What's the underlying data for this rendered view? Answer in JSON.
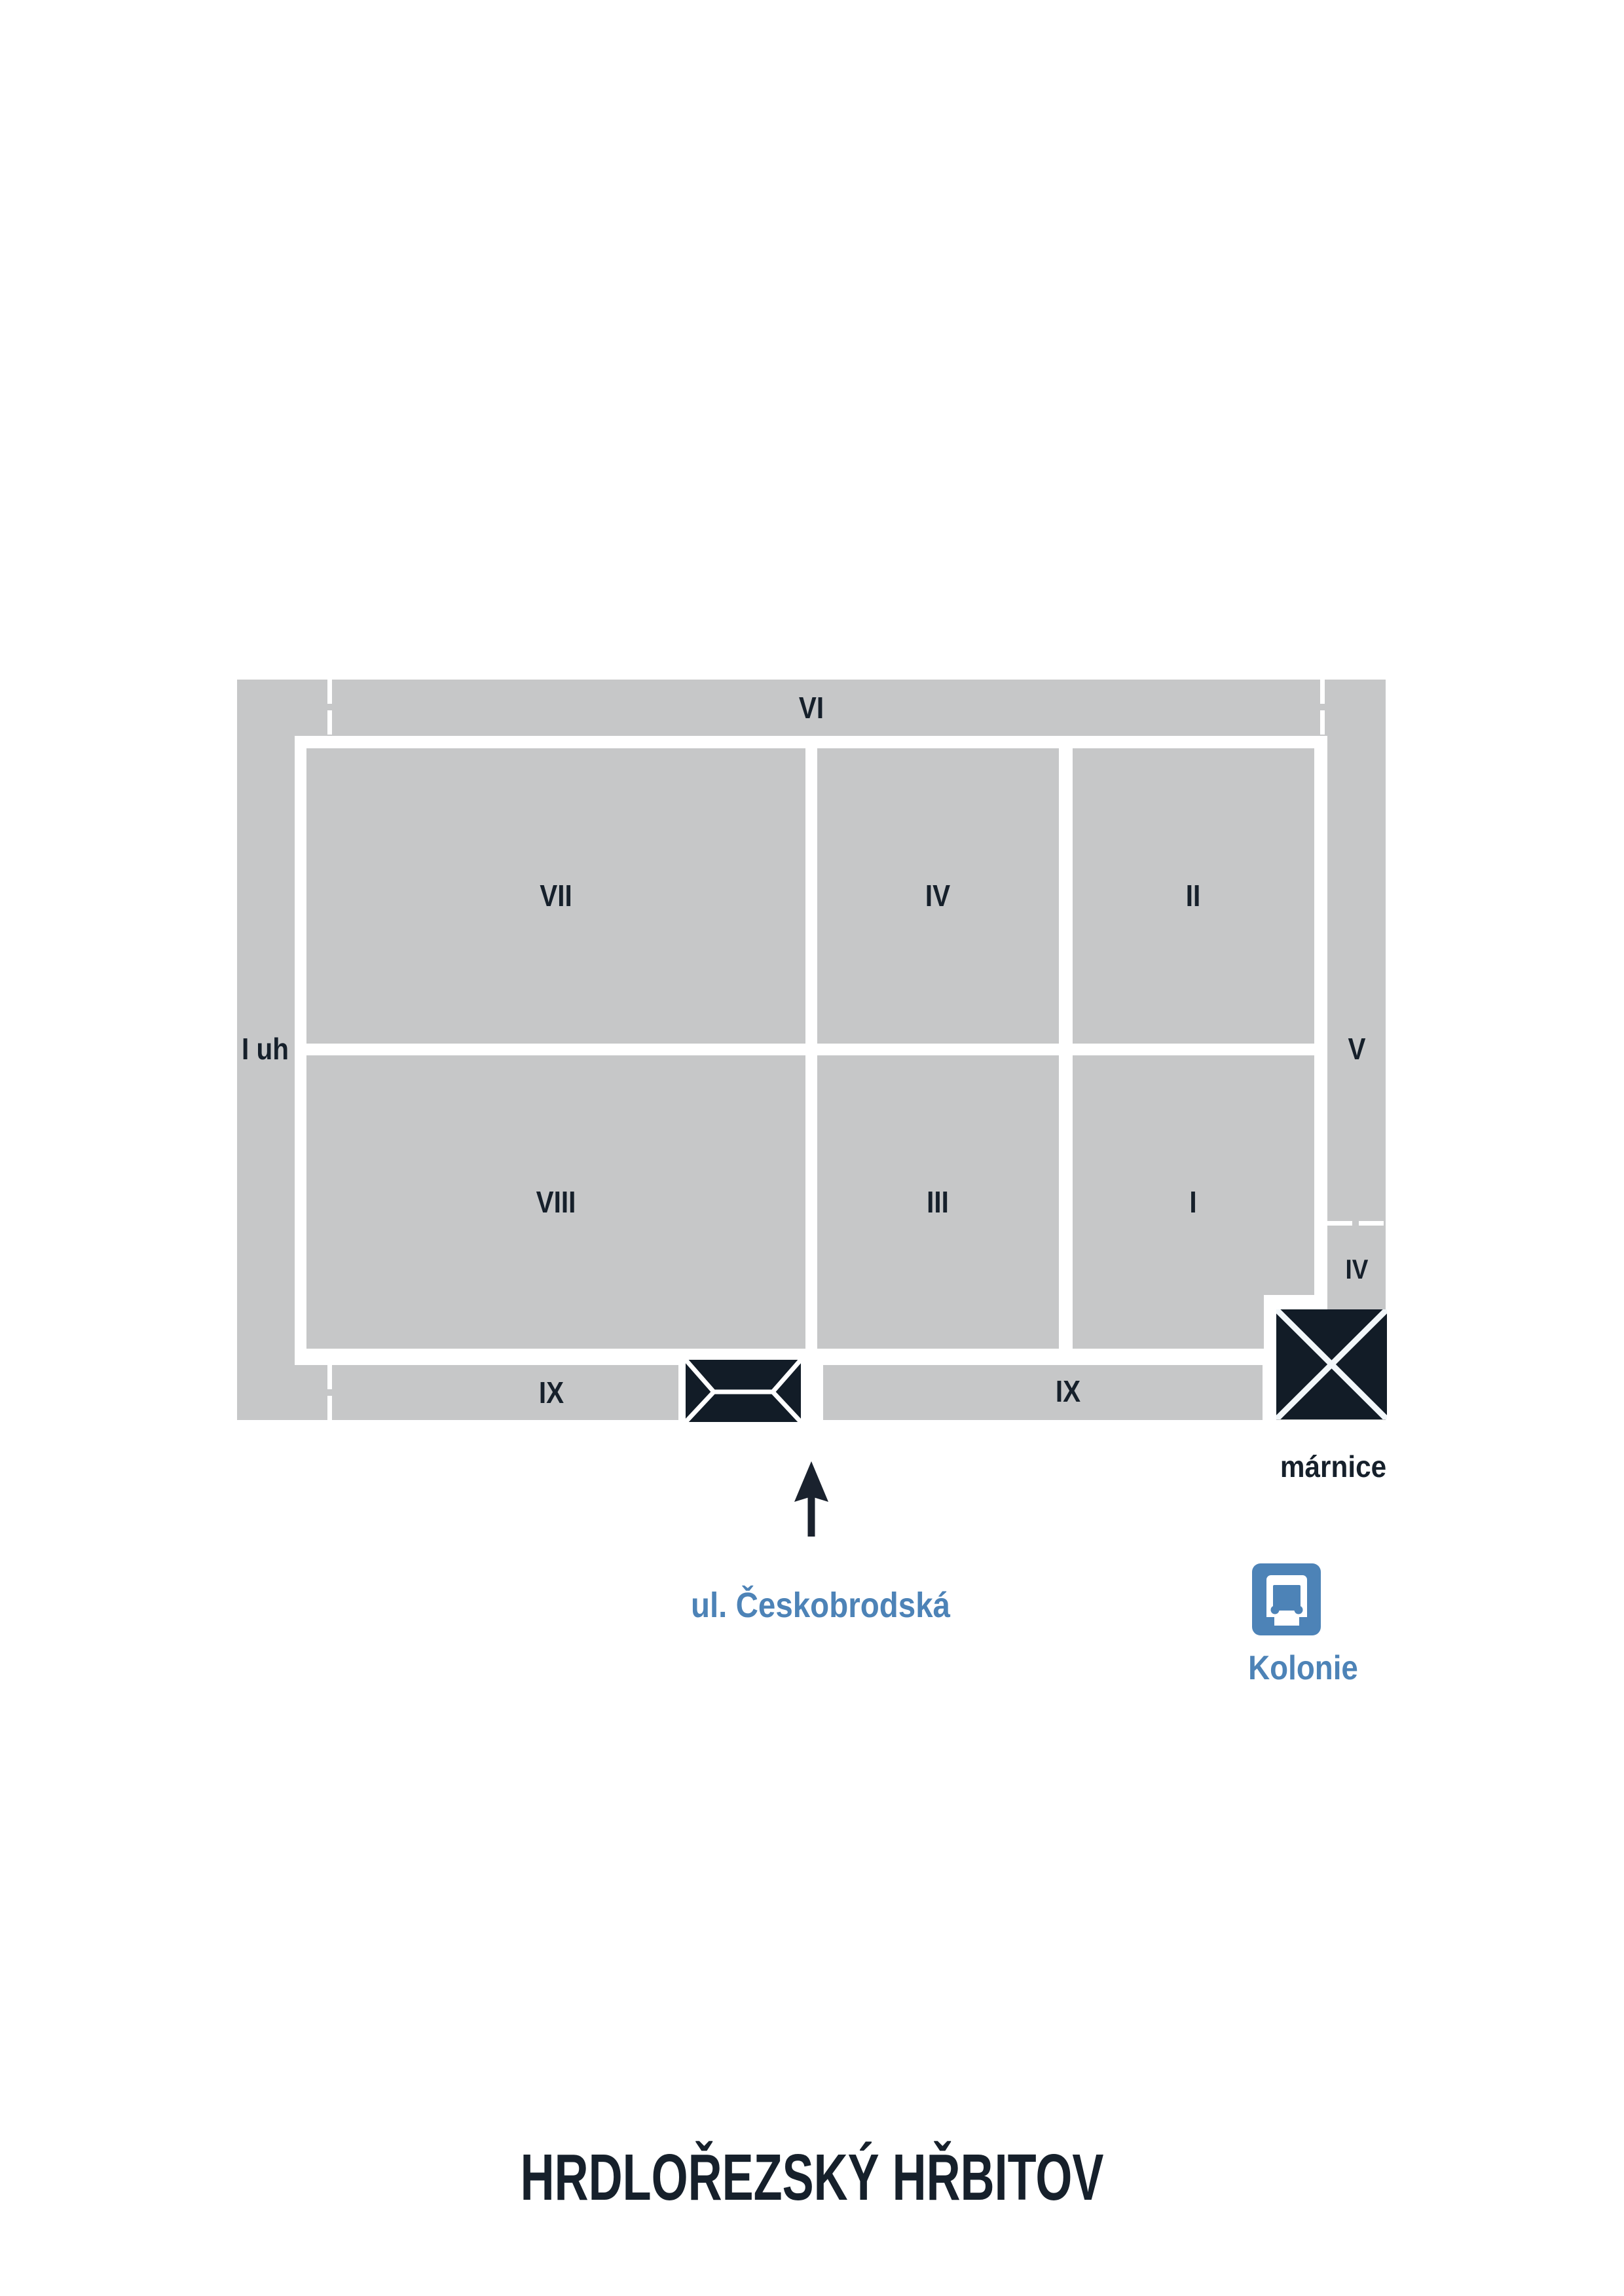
{
  "title": "HRDLOŘEZSKÝ HŘBITOV",
  "colors": {
    "area_gray": "#c6c7c8",
    "ink_dark": "#16202b",
    "accent_blue": "#4d83b7",
    "path_white": "#ffffff"
  },
  "map": {
    "perimeter_sections": {
      "top": "VI",
      "left": "I uh",
      "right_upper": "V",
      "right_lower": "IV",
      "bottom_left": "IX",
      "bottom_right": "IX"
    },
    "blocks": [
      {
        "label": "VII"
      },
      {
        "label": "IV"
      },
      {
        "label": "II"
      },
      {
        "label": "VIII"
      },
      {
        "label": "III"
      },
      {
        "label": "I"
      }
    ],
    "morgue_label": "márnice",
    "street_label": "ul. Českobrodská",
    "colony_label": "Kolonie",
    "icons": [
      "envelope-gate-icon",
      "x-square-icon",
      "up-arrow-icon",
      "bus-stop-icon"
    ]
  }
}
